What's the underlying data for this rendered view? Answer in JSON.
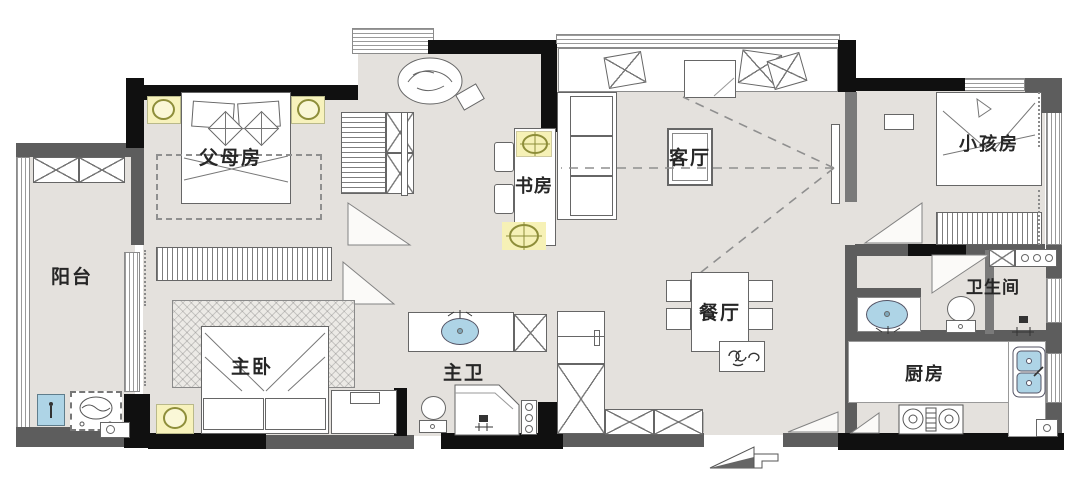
{
  "rooms": {
    "balcony": {
      "label": "阳台"
    },
    "parents_room": {
      "label": "父母房"
    },
    "master_bedroom": {
      "label": "主卧"
    },
    "study": {
      "label": "书房"
    },
    "living_room": {
      "label": "客厅"
    },
    "dining_area": {
      "label": "餐厅"
    },
    "master_bath": {
      "label": "主卫"
    },
    "kids_room": {
      "label": "小孩房"
    },
    "bathroom": {
      "label": "卫生间"
    },
    "kitchen": {
      "label": "厨房"
    }
  },
  "colors": {
    "floor": "#e4e1dd",
    "wall_dark": "#101010",
    "wall_gray": "#5d5d5d",
    "water_blue": "#aed4e6",
    "lamp_yellow": "#f7f2bc",
    "outline": "#666666"
  },
  "compass": {
    "name": "north-arrow"
  }
}
